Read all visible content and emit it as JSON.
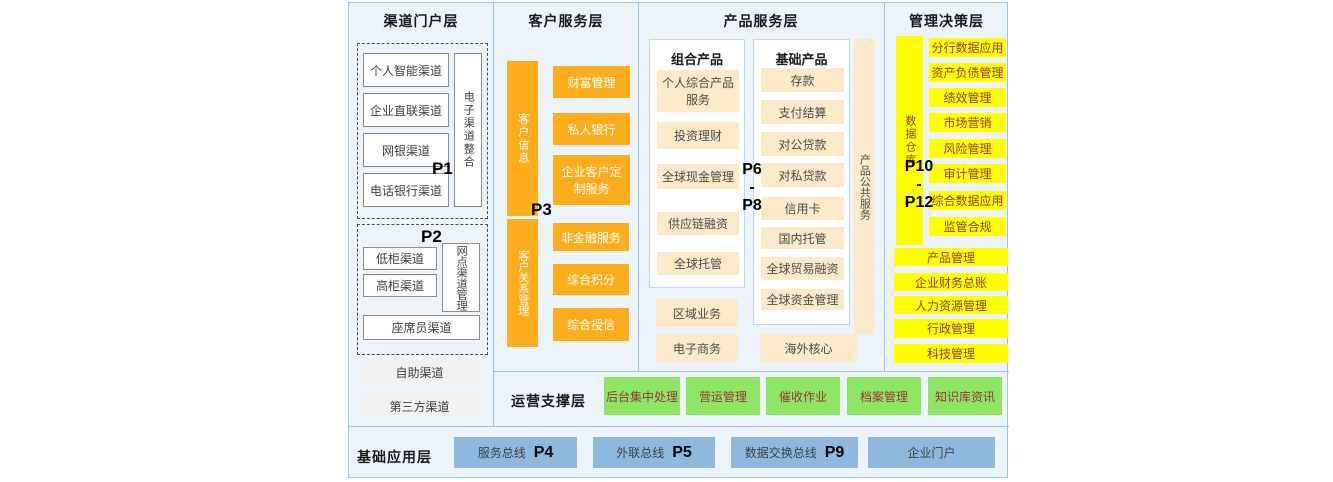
{
  "colors": {
    "background": "#FFFFFF",
    "panel_bg": "#EDF3FA",
    "panel_border": "#9DC3E6",
    "orange": "#FBAD1B",
    "cream": "#FBE9C7",
    "yellow": "#FFFF00",
    "green": "#8EE563",
    "blue": "#8FB8DF",
    "dark_red_text": "#953735"
  },
  "layers": {
    "channel_portal": {
      "title": "渠道门户层",
      "p1": "P1",
      "p2": "P2",
      "group1": {
        "items": [
          "个人智能渠道",
          "企业直联渠道",
          "网银渠道",
          "电话银行渠道"
        ],
        "side": "电子渠道整合"
      },
      "group2": {
        "items": [
          "低柜渠道",
          "高柜渠道"
        ],
        "side": "网点渠道管理",
        "wide_item": "座席员渠道"
      },
      "extra_items": [
        "自助渠道",
        "第三方渠道"
      ]
    },
    "customer_service": {
      "title": "客户服务层",
      "p3": "P3",
      "top_side": "客户信息",
      "top_items": [
        "财富管理",
        "私人银行",
        "企业客户定制服务"
      ],
      "bottom_side": "客户关系管理",
      "bottom_items": [
        "非金融服务",
        "综合积分",
        "综合授信"
      ]
    },
    "product_service": {
      "title": "产品服务层",
      "p_range": {
        "from": "P6",
        "sep": "-",
        "to": "P8"
      },
      "combo": {
        "title": "组合产品",
        "items": [
          "个人综合产品服务",
          "投资理财",
          "全球现金管理",
          "供应链融资",
          "全球托管"
        ]
      },
      "basic": {
        "title": "基础产品",
        "items": [
          "存款",
          "支付结算",
          "对公贷款",
          "对私贷款",
          "信用卡",
          "国内托管",
          "全球贸易融资",
          "全球资金管理"
        ]
      },
      "side": "产品公共服务",
      "extra_left": [
        "区域业务",
        "电子商务"
      ],
      "extra_right": "海外核心"
    },
    "management_decision": {
      "title": "管理决策层",
      "p_range": {
        "from": "P10",
        "sep": "-",
        "to": "P12"
      },
      "side": "数据仓库",
      "items": [
        "分行数据应用",
        "资产负债管理",
        "绩效管理",
        "市场营销",
        "风险管理",
        "审计管理",
        "综合数据应用",
        "监管合规"
      ],
      "full_items": [
        "产品管理",
        "企业财务总账",
        "人力资源管理",
        "行政管理",
        "科技管理"
      ]
    },
    "operations_support": {
      "title": "运营支撑层",
      "items": [
        "后台集中处理",
        "营运管理",
        "催收作业",
        "档案管理",
        "知识库资讯"
      ]
    },
    "foundation_application": {
      "title": "基础应用层",
      "items": [
        {
          "label": "服务总线",
          "p": "P4"
        },
        {
          "label": "外联总线",
          "p": "P5"
        },
        {
          "label": "数据交换总线",
          "p": "P9"
        },
        {
          "label": "企业门户",
          "p": ""
        }
      ]
    }
  }
}
